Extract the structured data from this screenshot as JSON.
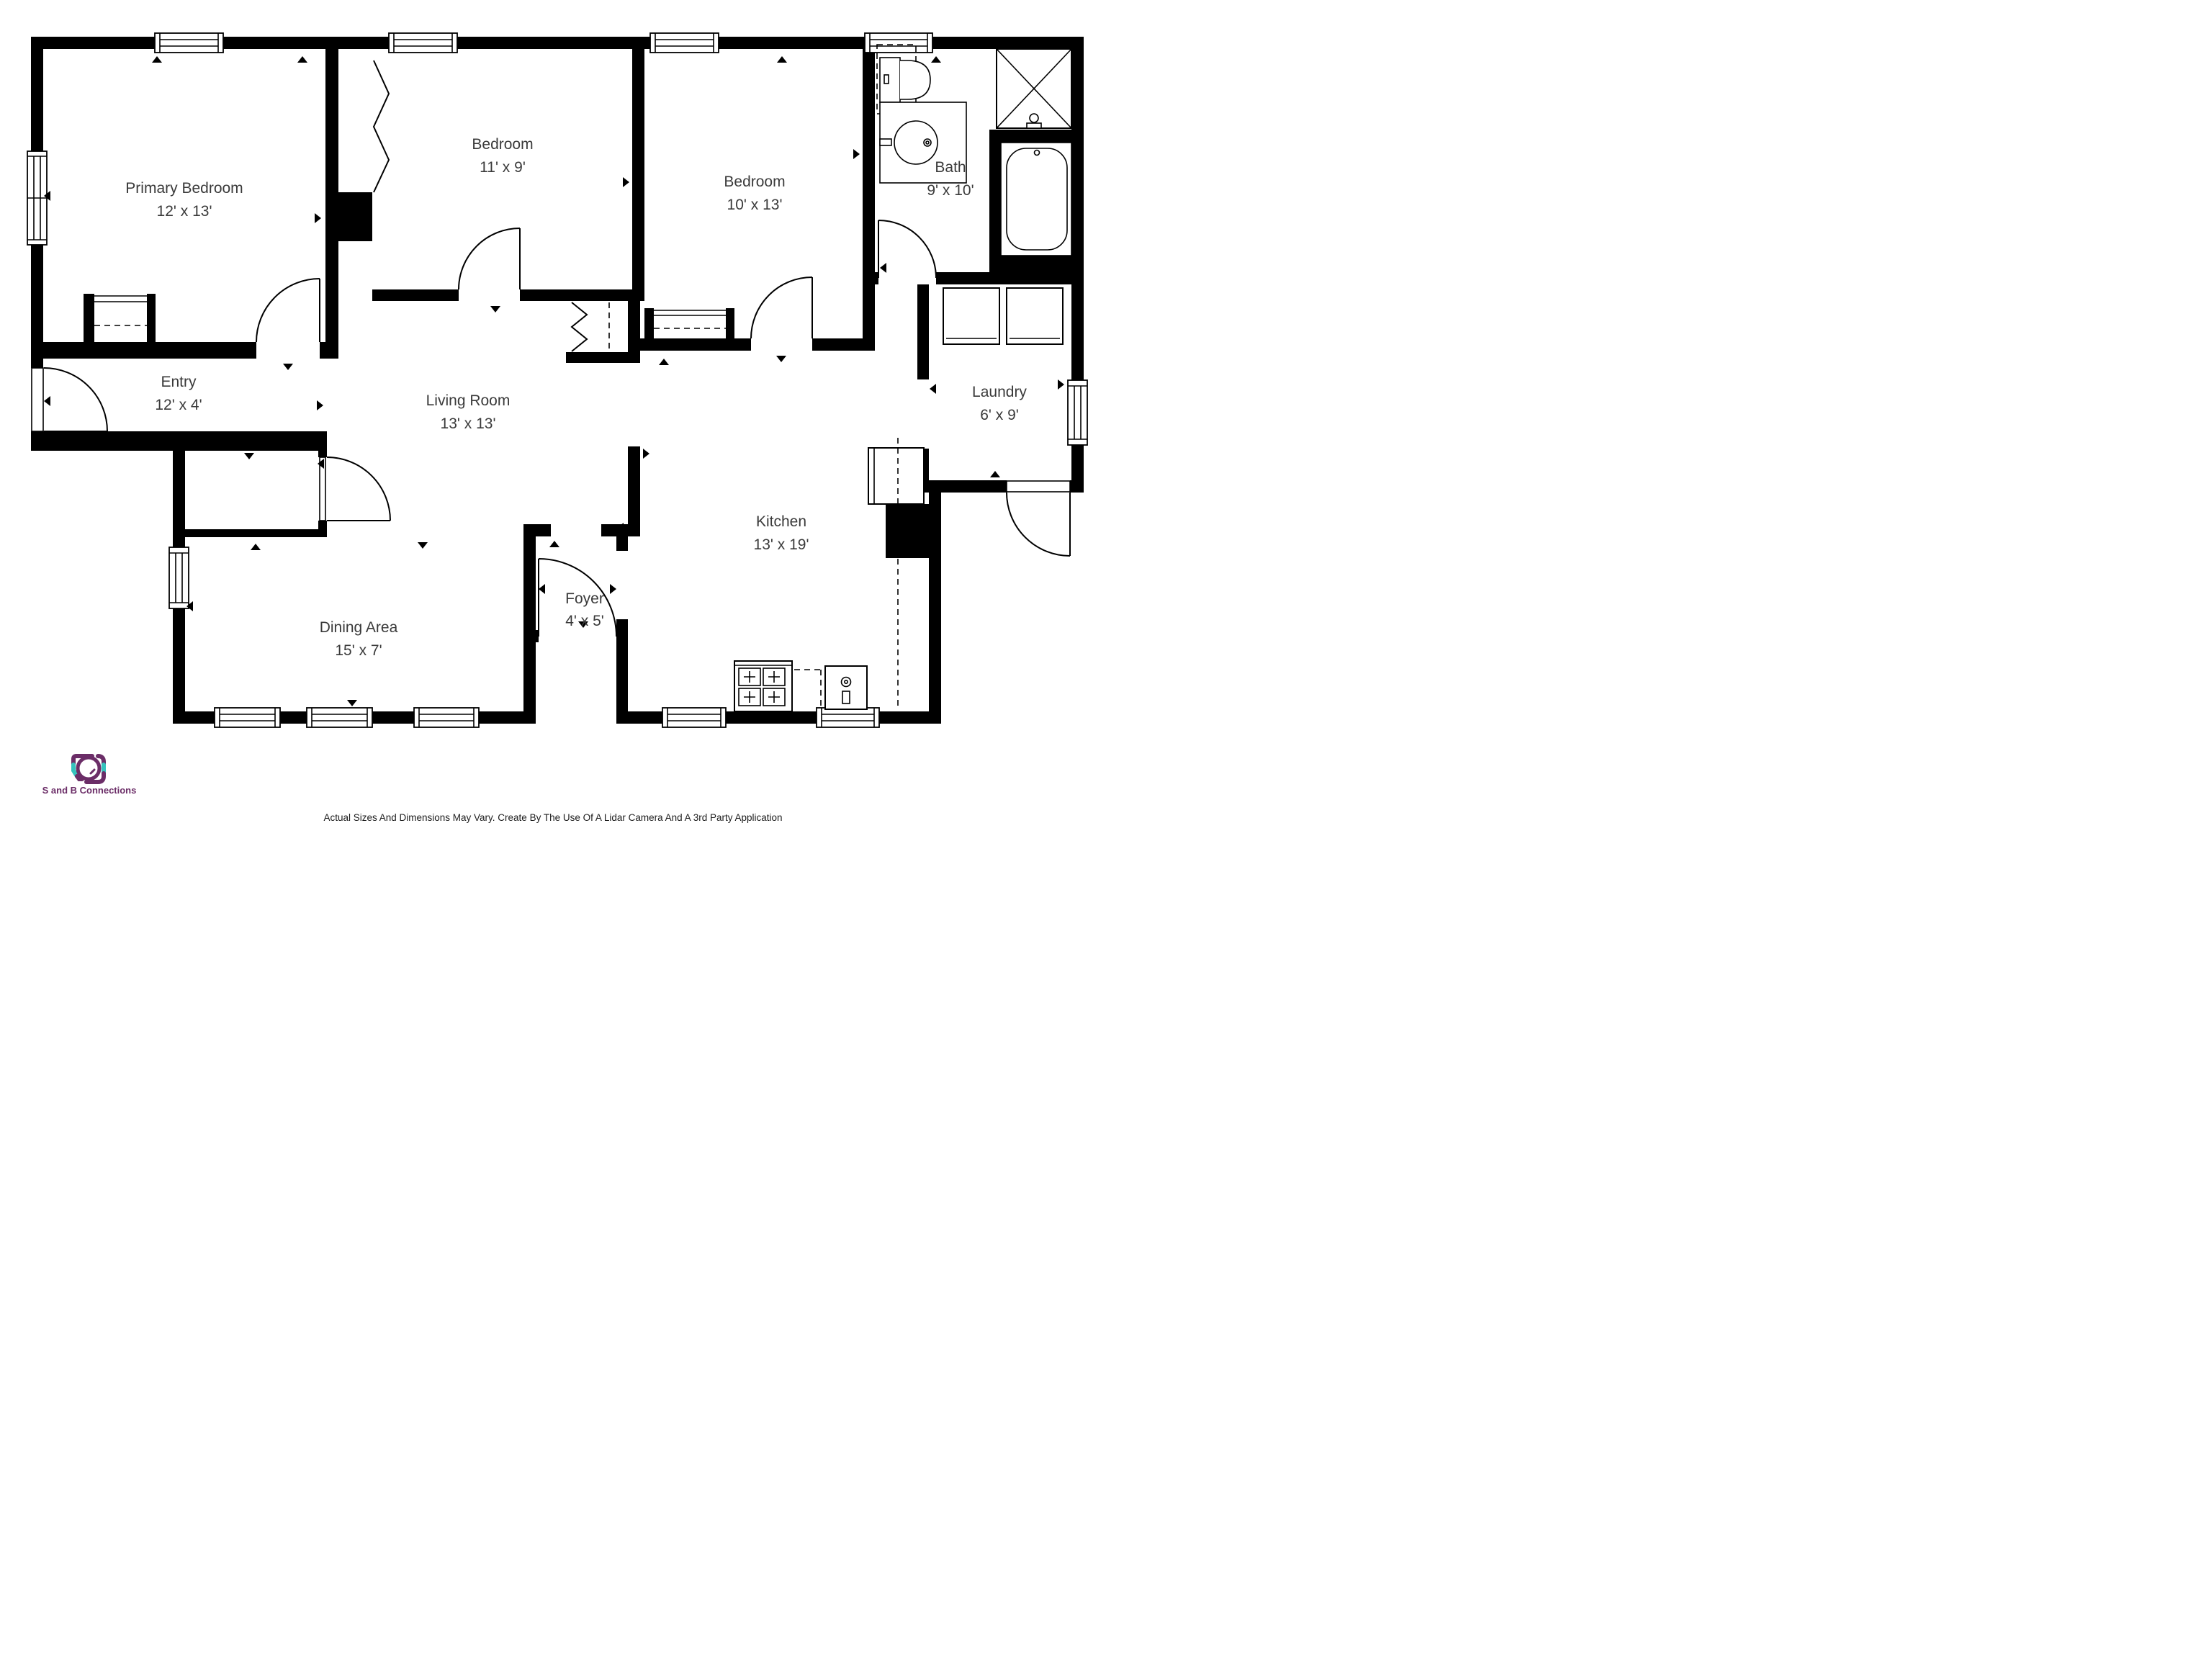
{
  "floor_plan": {
    "wall_color": "#000000",
    "background": "#ffffff",
    "label_color": "#3a3a3a",
    "rooms": [
      {
        "id": "primary-bedroom",
        "name": "Primary Bedroom",
        "dims": "12' x 13'"
      },
      {
        "id": "bedroom-2",
        "name": "Bedroom",
        "dims": "11' x 9'"
      },
      {
        "id": "bedroom-3",
        "name": "Bedroom",
        "dims": "10' x 13'"
      },
      {
        "id": "bath",
        "name": "Bath",
        "dims": "9' x 10'"
      },
      {
        "id": "laundry",
        "name": "Laundry",
        "dims": "6' x 9'"
      },
      {
        "id": "entry",
        "name": "Entry",
        "dims": "12' x 4'"
      },
      {
        "id": "living-room",
        "name": "Living Room",
        "dims": "13' x 13'"
      },
      {
        "id": "kitchen",
        "name": "Kitchen",
        "dims": "13' x 19'"
      },
      {
        "id": "dining-area",
        "name": "Dining Area",
        "dims": "15' x 7'"
      },
      {
        "id": "foyer",
        "name": "Foyer",
        "dims": "4' x 5'"
      }
    ],
    "fixture_icons": [
      "toilet-icon",
      "sink-vanity-icon",
      "shower-icon",
      "bathtub-icon",
      "washer-icon",
      "dryer-icon",
      "refrigerator-icon",
      "stove-icon",
      "kitchen-sink-icon",
      "closet-rod-icon",
      "bifold-door-icon",
      "door-swing-icon",
      "window-icon",
      "marker-arrow-icon"
    ]
  },
  "footer": {
    "logo_text": "S and B Connections",
    "logo_purple": "#6b2d67",
    "logo_teal": "#35c3bd",
    "disclaimer": "Actual Sizes And Dimensions May Vary. Create By The Use Of A Lidar Camera And A 3rd Party Application"
  }
}
